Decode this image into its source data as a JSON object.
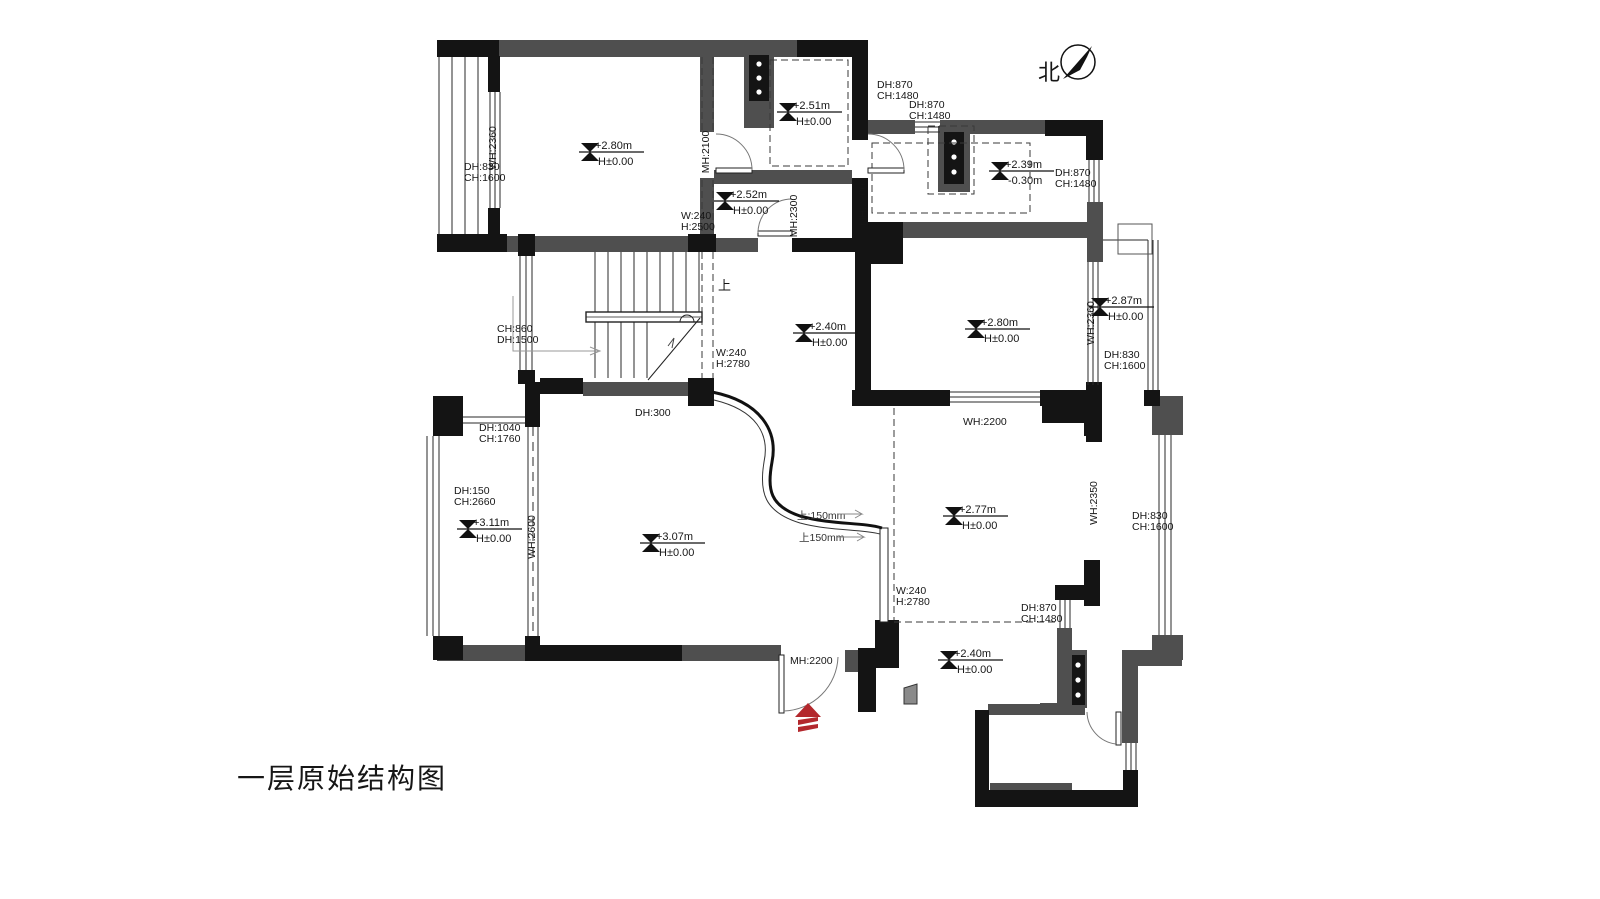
{
  "title": "一层原始结构图",
  "compass_label": "北",
  "stairs": {
    "up": "上",
    "note_up1": "上:150mm",
    "note_up2": "上150mm"
  },
  "markers": [
    {
      "value": "+2.80m",
      "base": "H±0.00"
    },
    {
      "value": "+2.51m",
      "base": "H±0.00"
    },
    {
      "value": "+2.52m",
      "base": "H±0.00"
    },
    {
      "value": "+2.39m",
      "base": "-0.30m"
    },
    {
      "value": "+2.80m",
      "base": "H±0.00"
    },
    {
      "value": "+2.87m",
      "base": "H±0.00"
    },
    {
      "value": "+2.40m",
      "base": "H±0.00"
    },
    {
      "value": "+3.11m",
      "base": "H±0.00"
    },
    {
      "value": "+3.07m",
      "base": "H±0.00"
    },
    {
      "value": "+2.77m",
      "base": "H±0.00"
    },
    {
      "value": "+2.40m",
      "base": "H±0.00"
    }
  ],
  "openings": [
    {
      "l1": "DH:830",
      "l2": "CH:1600"
    },
    {
      "l1": "WH:2360"
    },
    {
      "l1": "W:240",
      "l2": "H:2500"
    },
    {
      "l1": "MH:2100"
    },
    {
      "l1": "DH:870",
      "l2": "CH:1480"
    },
    {
      "l1": "DH:870",
      "l2": "CH:1480"
    },
    {
      "l1": "DH:870",
      "l2": "CH:1480"
    },
    {
      "l1": "MH:2300"
    },
    {
      "l1": "MH:2200"
    },
    {
      "l1": "WH:2360"
    },
    {
      "l1": "DH:830",
      "l2": "CH:1600"
    },
    {
      "l1": "CH:860",
      "l2": "DH:1500"
    },
    {
      "l1": "W:240",
      "l2": "H:2780"
    },
    {
      "l1": "DH:300"
    },
    {
      "l1": "DH:1040",
      "l2": "CH:1760"
    },
    {
      "l1": "DH:150",
      "l2": "CH:2660"
    },
    {
      "l1": "WH:2600"
    },
    {
      "l1": "WH:2200"
    },
    {
      "l1": "WH:2350"
    },
    {
      "l1": "DH:830",
      "l2": "CH:1600"
    },
    {
      "l1": "W:240",
      "l2": "H:2780"
    },
    {
      "l1": "DH:870",
      "l2": "CH:1480"
    },
    {
      "l1": "MH:2200"
    }
  ],
  "colors": {
    "wall_black": "#141414",
    "wall_gray": "#4f4f4f",
    "entry_arrow_red": "#b3282d"
  }
}
